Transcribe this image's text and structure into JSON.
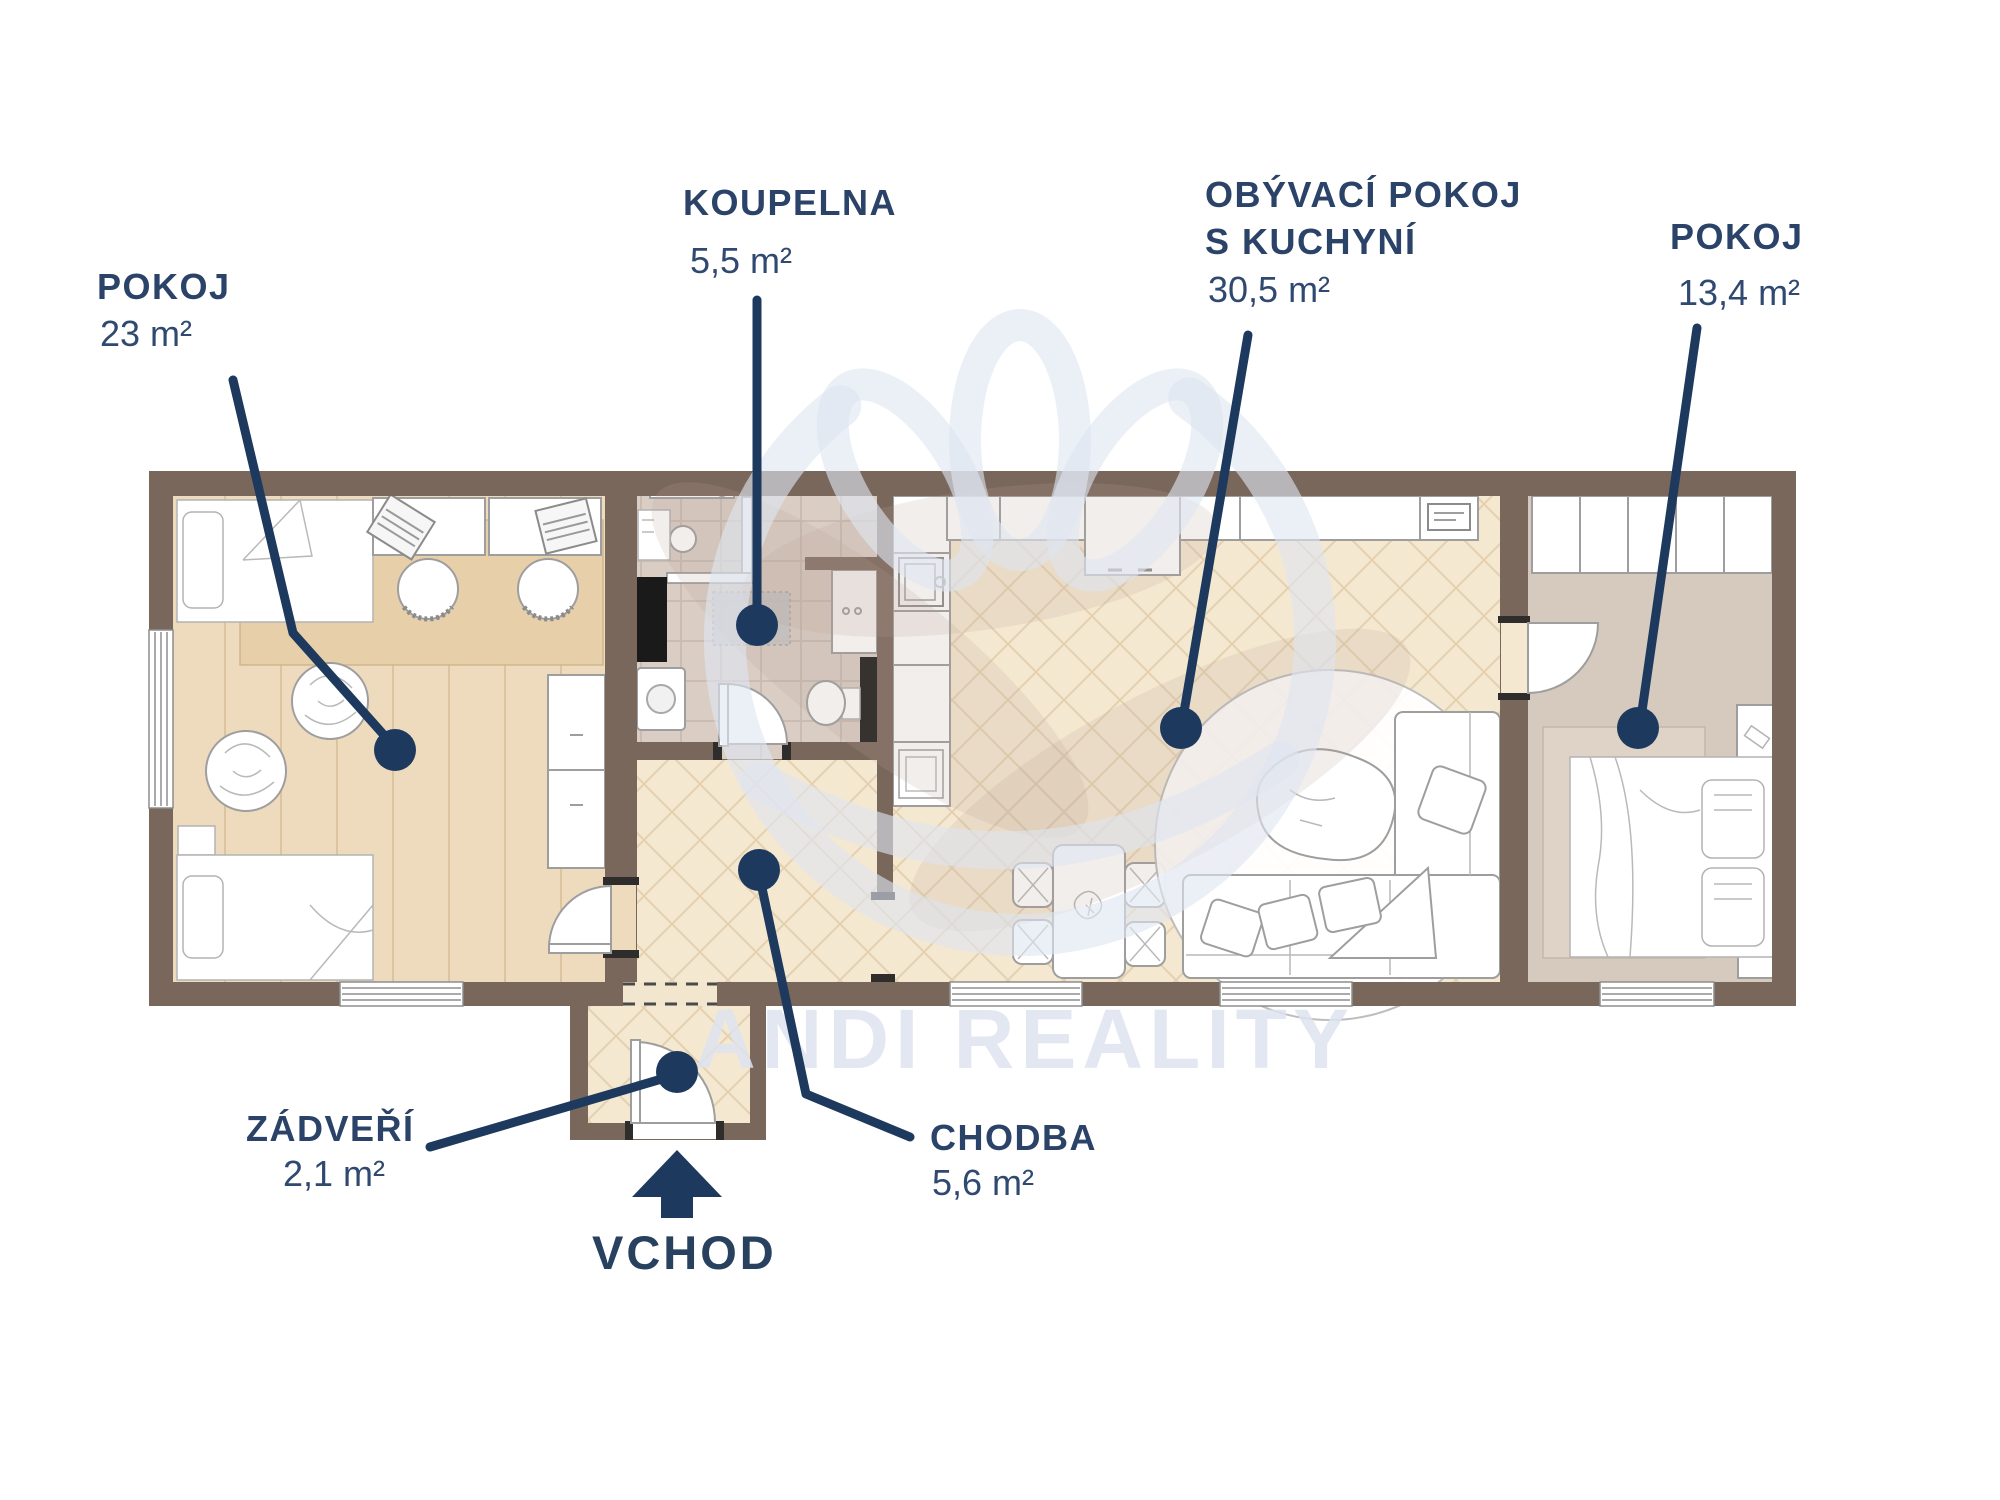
{
  "title": "Floor plan with room areas",
  "watermark": {
    "brand": "ANDI REALITY"
  },
  "entrance": {
    "label": "VCHOD"
  },
  "rooms": [
    {
      "id": "pokoj-left",
      "label": "POKOJ",
      "area": "23 m²"
    },
    {
      "id": "koupelna",
      "label": "KOUPELNA",
      "area": "5,5 m²"
    },
    {
      "id": "obyvaci-pokoj-s-kuchyni",
      "label": "OBÝVACÍ POKOJ",
      "label2": "S KUCHYNÍ",
      "area": "30,5 m²"
    },
    {
      "id": "pokoj-right",
      "label": "POKOJ",
      "area": "13,4 m²"
    },
    {
      "id": "zadveri",
      "label": "ZÁDVEŘÍ",
      "area": "2,1 m²"
    },
    {
      "id": "chodba",
      "label": "CHODBA",
      "area": "5,6 m²"
    }
  ],
  "colors": {
    "label_navy": "#2b4368",
    "accent_navy": "#1d3a5e",
    "wall_brown": "#7a675c",
    "floor_wood": "#eedbbe",
    "floor_tile": "#d9cdc4",
    "floor_herringbone": "#f5e8d0",
    "floor_taupe": "#d5cabd",
    "watermark_blue": "#dfe5f0"
  }
}
